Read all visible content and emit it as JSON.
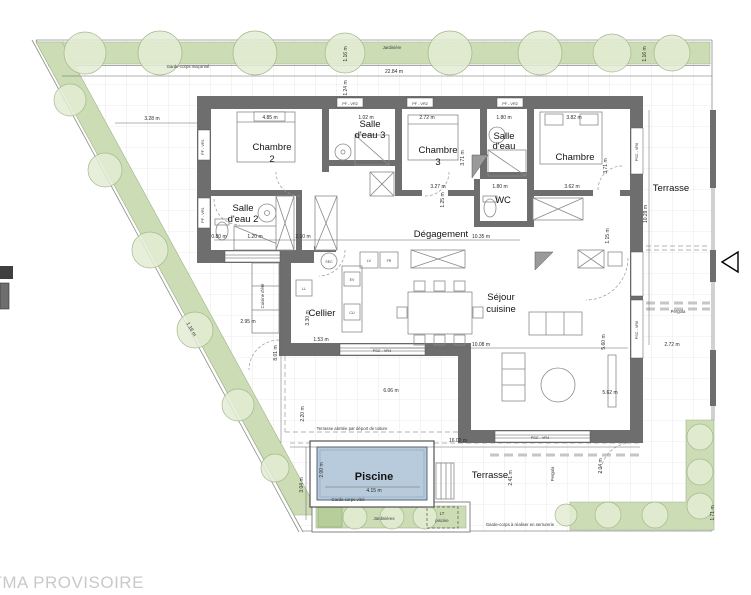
{
  "meta": {
    "title": "PLAN TMA PROVISOIRE"
  },
  "colors": {
    "wall": "#6e6e6e",
    "green": "#ccdcb4",
    "pool": "#b8cbdc",
    "title_gray": "#c9c9c9"
  },
  "rooms": {
    "chambre2_1": "Chambre",
    "chambre2_2": "2",
    "sde3_1": "Salle",
    "sde3_2": "d'eau 3",
    "chambre3_1": "Chambre",
    "chambre3_2": "3",
    "sde_1": "Salle",
    "sde_2": "d'eau",
    "chambre": "Chambre",
    "sde2_1": "Salle",
    "sde2_2": "d'eau 2",
    "wc": "WC",
    "degagement": "Dégagement",
    "cellier": "Cellier",
    "sejour_1": "Séjour",
    "sejour_2": "cuisine",
    "terrasse": "Terrasse",
    "piscine": "Piscine"
  },
  "outdoor": {
    "jardiniere_top": "Jardinière",
    "jardinieres": "Jardinières",
    "garde_corps_maconne": "Garde-corps maçonné",
    "garde_corps_serrurerie": "Garde-corps à réaliser en serrurerie",
    "garde_corps_vitre": "Garde-corps vitré",
    "pergola": "Pergola",
    "cuisine_ete": "Cuisine d'été",
    "lt_1": "LT",
    "lt_2": "piscine",
    "toiture_note": "Terrasse abritée par déport de toiture"
  },
  "appliances": {
    "ll": "LL",
    "sec": "SEC",
    "ev": "EV",
    "cu": "CU",
    "lv": "LV",
    "fr": "FR"
  },
  "window_tags": {
    "top": "PF - VR2",
    "left": "PF - VR1",
    "bottom": "PSC - VR4",
    "right": "PSC - VR6"
  },
  "dims": {
    "d22_84": "22.84 m",
    "d1_16": "1.16 m",
    "d1_24": "1.24 m",
    "d3_28": "3.28 m",
    "d4_85": "4.85 m",
    "d1_02": "1.02 m",
    "d2_72": "2.72 m",
    "d1_80": "1.80 m",
    "d3_82": "3.82 m",
    "d3_71": "3.71 m",
    "d3_27": "3.27 m",
    "d3_62": "3.62 m",
    "d1_25": "1.25 m",
    "d1_15": "1.15 m",
    "d0_80": "0.80 m",
    "d1_20": "1.20 m",
    "d2_10": "2.10 m",
    "d10_35": "10.35 m",
    "d1_53": "1.53 m",
    "d3_30": "3.30 m",
    "d2_95": "2.95 m",
    "d8_01": "8.01 m",
    "d10_08": "10.08 m",
    "d5_60": "5.60 m",
    "d5_62": "5.62 m",
    "d6_06": "6.06 m",
    "d2_20": "2.20 m",
    "d16_02": "16.02 m",
    "d4_15": "4.15 m",
    "d2_00": "2.00 m",
    "d3_04": "3.04 m",
    "d10_29": "10.29 m",
    "d2_41": "2.41 m",
    "d2_04": "2.04 m",
    "d1_71": "1.71 m"
  }
}
